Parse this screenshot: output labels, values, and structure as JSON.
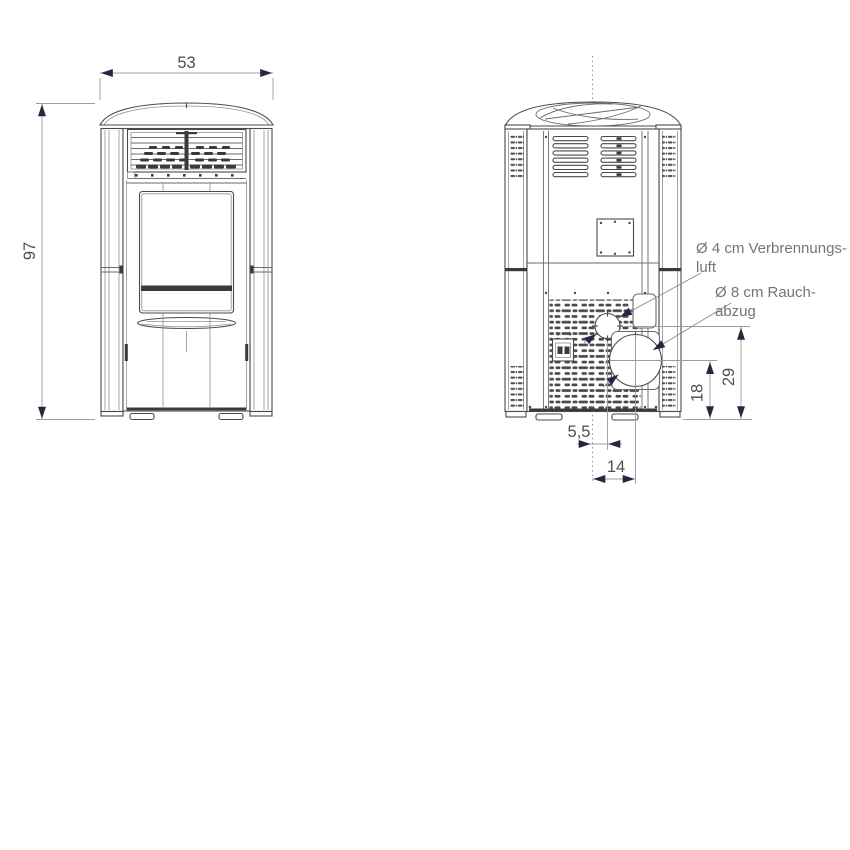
{
  "diagram": {
    "type": "technical-dimension-drawing",
    "subject": "pellet stove front and rear elevation",
    "dimensions": {
      "width": {
        "value": "53"
      },
      "height": {
        "value": "97"
      },
      "air_offset": {
        "value": "5,5"
      },
      "flue_offset": {
        "value": "14"
      },
      "flue_height": {
        "value": "18"
      },
      "air_height": {
        "value": "29"
      }
    },
    "annotations": {
      "combustion_air": {
        "line1": "Ø 4 cm Verbrennungs-",
        "line2": "luft"
      },
      "flue": {
        "line1": "Ø 8 cm Rauch-",
        "line2": "abzug"
      }
    },
    "colors": {
      "background": "#ffffff",
      "outline": "#4a4a4a",
      "detail_line": "#8f8f8f",
      "dark_detail": "#3a3a3a",
      "dimension_line": "#9c9c9c",
      "arrowhead": "#23273f",
      "dimension_text": "#4f4f4f",
      "annotation_text": "#757575"
    }
  }
}
